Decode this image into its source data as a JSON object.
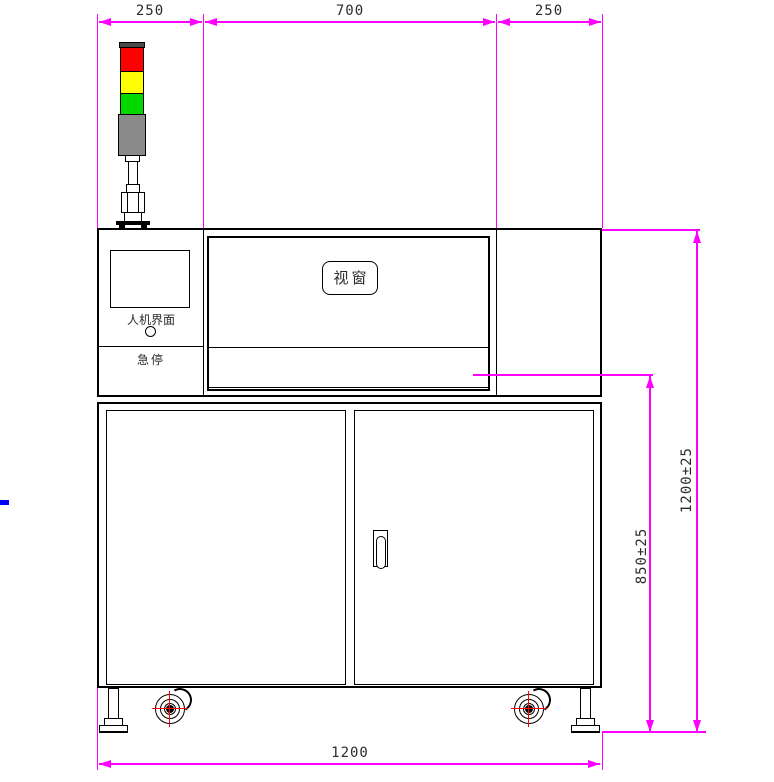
{
  "title": "machine front-view CAD drawing",
  "dimensions": {
    "top_left": "250",
    "top_center": "700",
    "top_right": "250",
    "right_overall": "1200±25",
    "right_table": "850±25",
    "bottom": "1200"
  },
  "labels": {
    "window": "视窗",
    "hmi": "人机界面",
    "estop": "急停"
  },
  "colors": {
    "dimension": "#ff00ff",
    "outline": "#000000",
    "crosshair": "#ff0000",
    "stray": "#0000ff",
    "light_red": "#ff0000",
    "light_yellow": "#ffff00",
    "light_green": "#00d800",
    "light_gray": "#8a8a8a",
    "cap_gray": "#4a4a4a"
  },
  "tower_lights": [
    "red",
    "yellow",
    "green",
    "gray"
  ]
}
